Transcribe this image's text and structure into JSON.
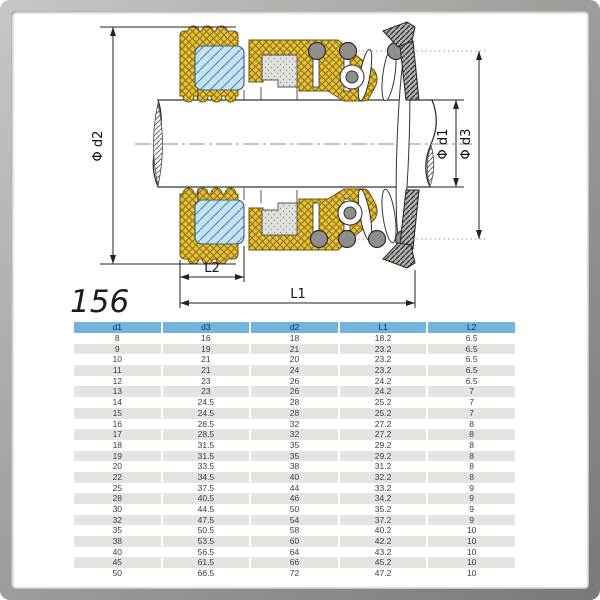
{
  "diagram": {
    "model": "156",
    "labels": {
      "d2": "Φ d2",
      "d1": "Φ d1",
      "d3": "Φ d3",
      "l1": "L1",
      "l2": "L2"
    },
    "colors": {
      "rubber_bellows": "#e8c23a",
      "seal_face": "#c3e4f4",
      "stationary_seat": "#e0e0dc",
      "collar": "#b3b3ae",
      "spring": "#8e8e8a",
      "line": "#222222"
    }
  },
  "table": {
    "header_bg": "#74b3dc",
    "alt_row_bg": "#e4e4e1",
    "headers": [
      "d1",
      "d3",
      "d2",
      "L1",
      "L2"
    ],
    "rows": [
      [
        "8",
        "16",
        "18",
        "18.2",
        "6.5"
      ],
      [
        "9",
        "19",
        "21",
        "23.2",
        "6.5"
      ],
      [
        "10",
        "21",
        "20",
        "23.2",
        "6.5"
      ],
      [
        "11",
        "21",
        "24",
        "23.2",
        "6.5"
      ],
      [
        "12",
        "23",
        "26",
        "24.2",
        "6.5"
      ],
      [
        "13",
        "23",
        "26",
        "24.2",
        "7"
      ],
      [
        "14",
        "24.5",
        "28",
        "25.2",
        "7"
      ],
      [
        "15",
        "24.5",
        "28",
        "25.2",
        "7"
      ],
      [
        "16",
        "28.5",
        "32",
        "27.2",
        "8"
      ],
      [
        "17",
        "28.5",
        "32",
        "27.2",
        "8"
      ],
      [
        "18",
        "31.5",
        "35",
        "29.2",
        "8"
      ],
      [
        "19",
        "31.5",
        "35",
        "29.2",
        "8"
      ],
      [
        "20",
        "33.5",
        "38",
        "31.2",
        "8"
      ],
      [
        "22",
        "34.5",
        "40",
        "32.2",
        "8"
      ],
      [
        "25",
        "37.5",
        "44",
        "33.2",
        "9"
      ],
      [
        "28",
        "40.5",
        "46",
        "34.2",
        "9"
      ],
      [
        "30",
        "44.5",
        "50",
        "35.2",
        "9"
      ],
      [
        "32",
        "47.5",
        "54",
        "37.2",
        "9"
      ],
      [
        "35",
        "50.5",
        "58",
        "40.2",
        "10"
      ],
      [
        "38",
        "53.5",
        "60",
        "42.2",
        "10"
      ],
      [
        "40",
        "56.5",
        "64",
        "43.2",
        "10"
      ],
      [
        "45",
        "61.5",
        "66",
        "45.2",
        "10"
      ],
      [
        "50",
        "66.5",
        "72",
        "47.2",
        "10"
      ]
    ]
  }
}
